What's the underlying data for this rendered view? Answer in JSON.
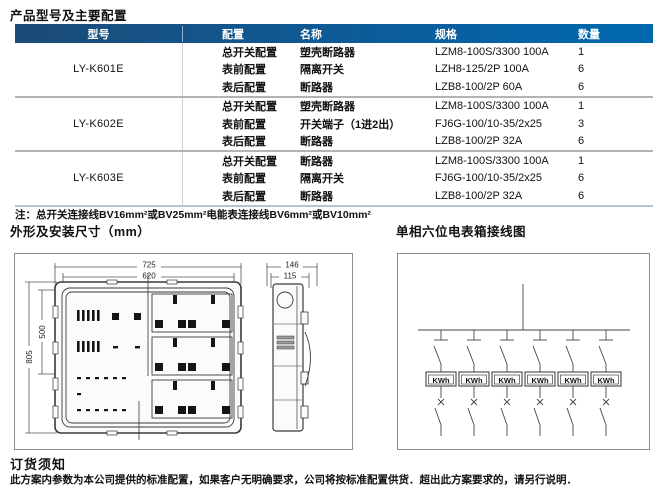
{
  "page": {
    "title": "产品型号及主要配置",
    "note": "注：总开关连接线BV16mm²或BV25mm²电能表连接线BV6mm²或BV10mm²",
    "section_left_title": "外形及安装尺寸（mm）",
    "section_right_title": "单相六位电表箱接线图",
    "order_notice_title": "订货须知",
    "order_notice_body": "此方案内参数为本公司提供的标准配置，如果客户无明确要求，公司将按标准配置供货．超出此方案要求的，请另行说明．"
  },
  "table": {
    "headers": [
      "型号",
      "配置",
      "名称",
      "规格",
      "数量"
    ],
    "groups": [
      {
        "model": "LY-K601E",
        "rows": [
          {
            "config": "总开关配置",
            "name": "塑壳断路器",
            "spec": "LZM8-100S/3300 100A",
            "qty": "1"
          },
          {
            "config": "表前配置",
            "name": "隔离开关",
            "spec": "LZH8-125/2P 100A",
            "qty": "6"
          },
          {
            "config": "表后配置",
            "name": "断路器",
            "spec": "LZB8-100/2P 60A",
            "qty": "6"
          }
        ]
      },
      {
        "model": "LY-K602E",
        "rows": [
          {
            "config": "总开关配置",
            "name": "塑壳断路器",
            "spec": "LZM8-100S/3300 100A",
            "qty": "1"
          },
          {
            "config": "表前配置",
            "name": "开关端子（1进2出）",
            "spec": "FJ6G-100/10-35/2x25",
            "qty": "3"
          },
          {
            "config": "表后配置",
            "name": "断路器",
            "spec": "LZB8-100/2P 32A",
            "qty": "6"
          }
        ]
      },
      {
        "model": "LY-K603E",
        "rows": [
          {
            "config": "总开关配置",
            "name": "断路器",
            "spec": "LZM8-100S/3300 100A",
            "qty": "1"
          },
          {
            "config": "表前配置",
            "name": "隔离开关",
            "spec": "FJ6G-100/10-35/2x25",
            "qty": "6"
          },
          {
            "config": "表后配置",
            "name": "断路器",
            "spec": "LZB8-100/2P 32A",
            "qty": "6"
          }
        ]
      }
    ]
  },
  "drawing": {
    "dims": {
      "width_outer": "725",
      "width_inner": "620",
      "height_outer": "805",
      "height_inner": "500",
      "depth_outer": "146",
      "depth_inner": "115"
    },
    "meter_label": "KWh"
  },
  "colors": {
    "header_bg": "#0068ae",
    "header_bg_dark": "#1b4b77",
    "separator": "#b3b3b3",
    "drawing_border": "#8f8f8f"
  }
}
